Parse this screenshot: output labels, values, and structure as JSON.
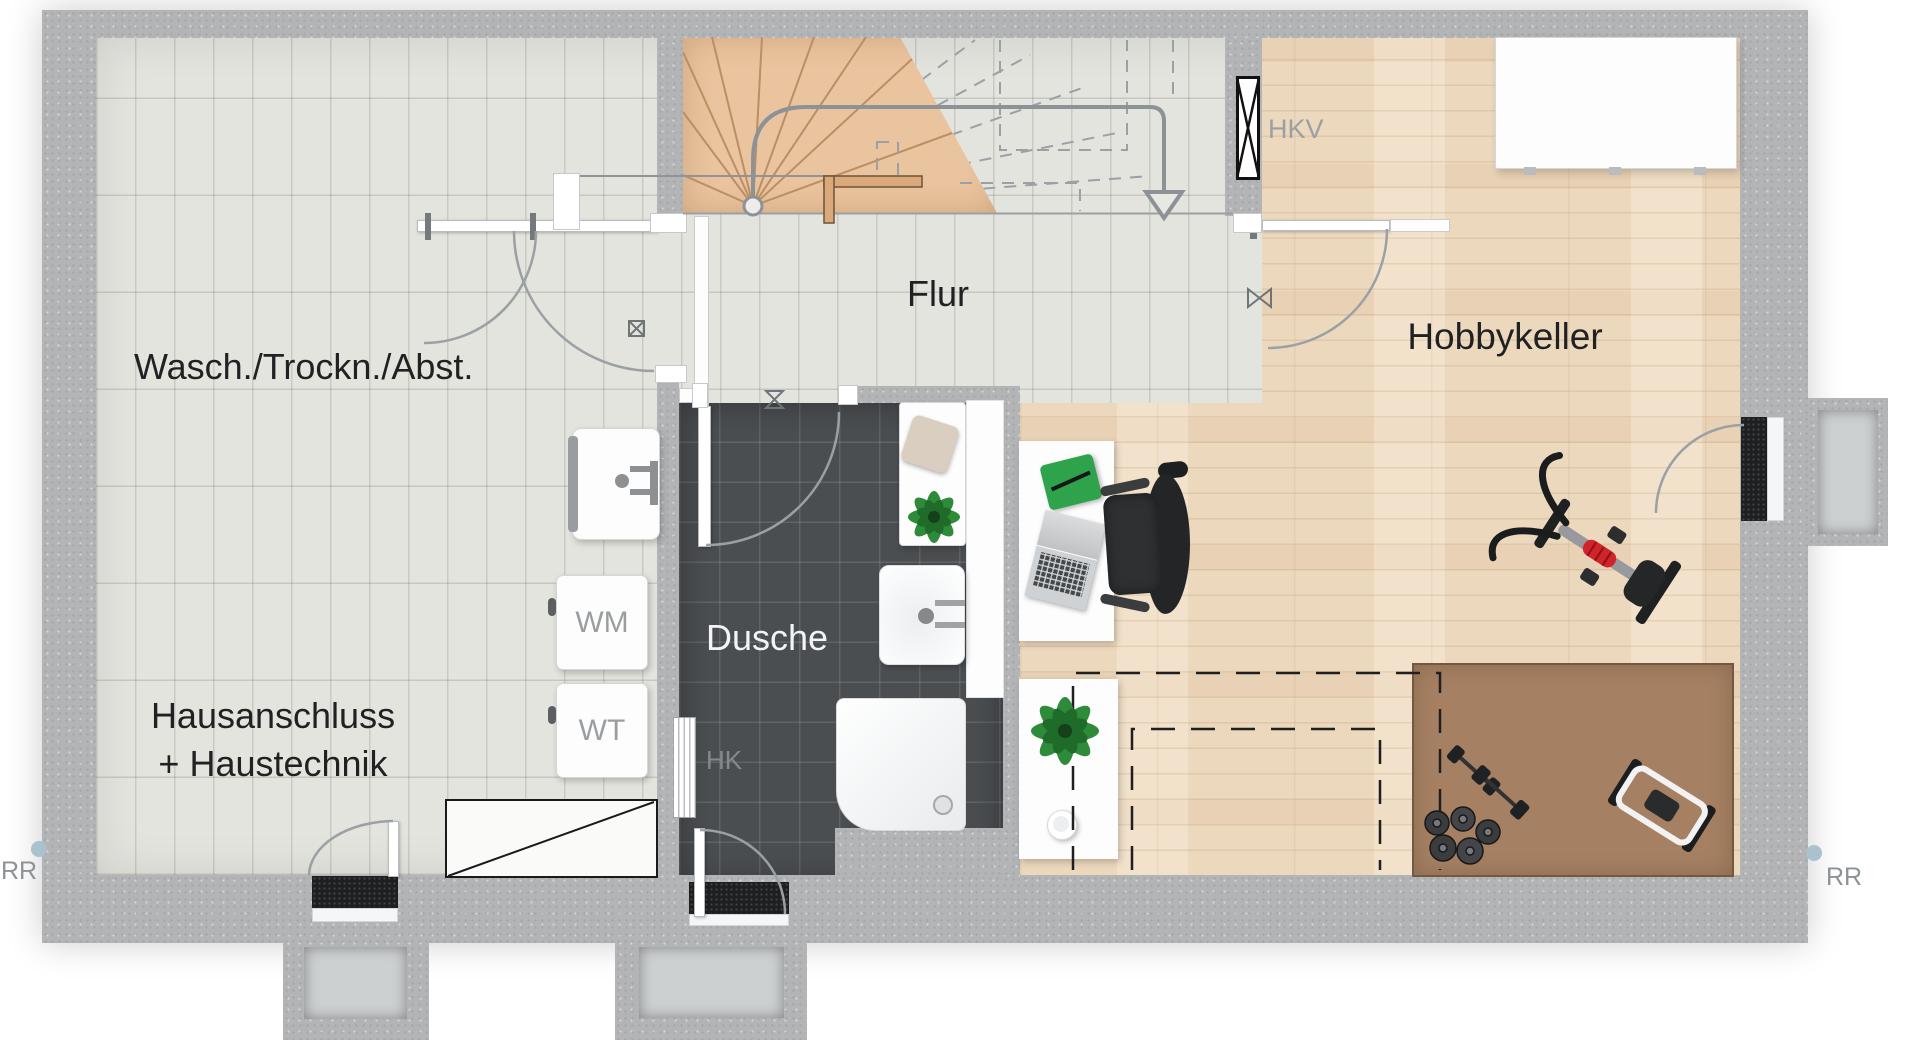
{
  "plan": {
    "kind": "basement floor plan",
    "labels": {
      "wasch": "Wasch./Trockn./Abst.",
      "haus_line1": "Hausanschluss",
      "haus_line2": "+ Haustechnik",
      "flur": "Flur",
      "hobby": "Hobbykeller",
      "dusche": "Dusche",
      "wm": "WM",
      "wt": "WT",
      "hk": "HK",
      "hkv": "HKV",
      "rr_left": "RR",
      "rr_right": "RR"
    },
    "icons": {
      "stair_arrow": "curved-arrow-down-icon",
      "valve": "valve-bowtie-icon",
      "floor_drain": "crossed-box-icon",
      "hkv_symbol": "crossed-rect-icon"
    },
    "palette": {
      "wall": "#b2b4b6",
      "tile_floor": "#e3e4de",
      "wood_floor": "#ecd8bd",
      "stair_wood": "#eac49e",
      "shower_tile": "#4b4e51",
      "gym_mat": "#a68063",
      "label_dark": "#1f2123",
      "label_gray": "#9aa0a4",
      "dash_black": "#1f1f1f",
      "accent_red": "#d0242a",
      "plant_green": "#2e8b3a",
      "rr_dot": "#a9c2cd"
    }
  }
}
